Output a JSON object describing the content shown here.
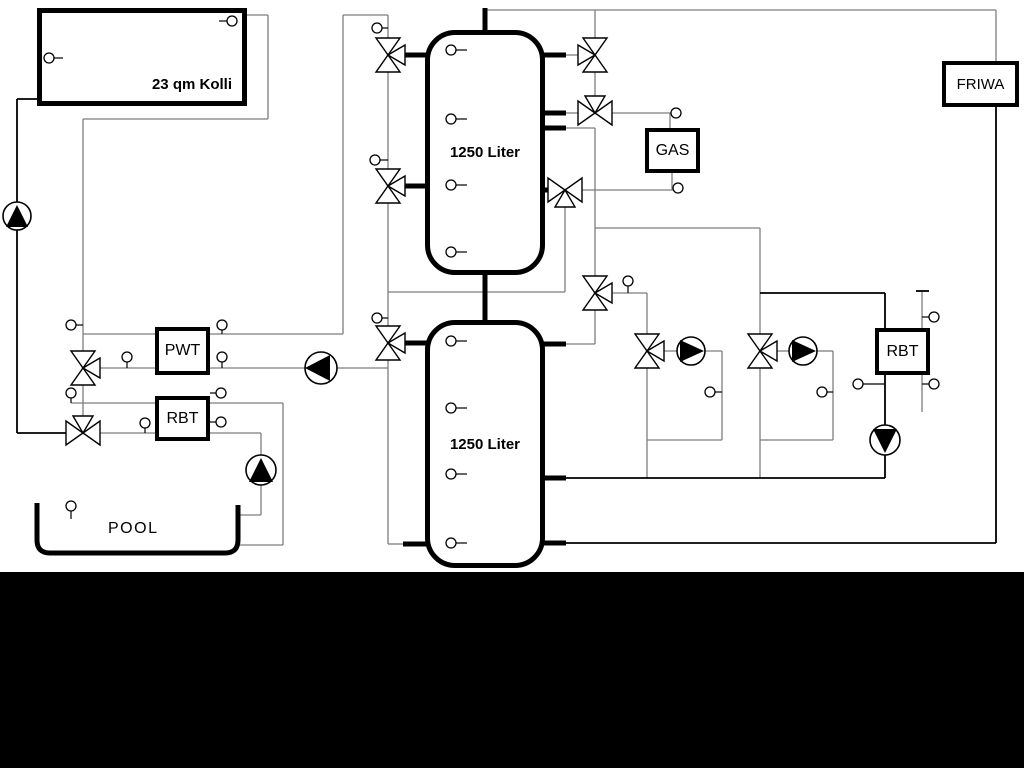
{
  "collector": {
    "label": "23 qm Kolli"
  },
  "tank_top": {
    "label": "1250 Liter"
  },
  "tank_bottom": {
    "label": "1250 Liter"
  },
  "pwt": {
    "label": "PWT"
  },
  "rbt_left": {
    "label": "RBT"
  },
  "rbt_right": {
    "label": "RBT"
  },
  "gas": {
    "label": "GAS"
  },
  "friwa": {
    "label": "FRIWA"
  },
  "pool": {
    "label": "POOL"
  },
  "colors": {
    "pipe_gray": "#7e7e7e",
    "pipe_black": "#000000",
    "canvas_background": "#ffffff",
    "bottom_band": "#000000"
  },
  "components": {
    "pumps": [
      {
        "name": "collector-pump",
        "direction": "up"
      },
      {
        "name": "pool-pump",
        "direction": "up"
      },
      {
        "name": "solar-charge-pump",
        "direction": "left"
      },
      {
        "name": "heating-circuit-1-pump",
        "direction": "right"
      },
      {
        "name": "heating-circuit-2-pump",
        "direction": "right"
      },
      {
        "name": "rbt-circuit-pump",
        "direction": "down"
      }
    ],
    "three_way_valves": 11,
    "temperature_sensors": 30
  }
}
